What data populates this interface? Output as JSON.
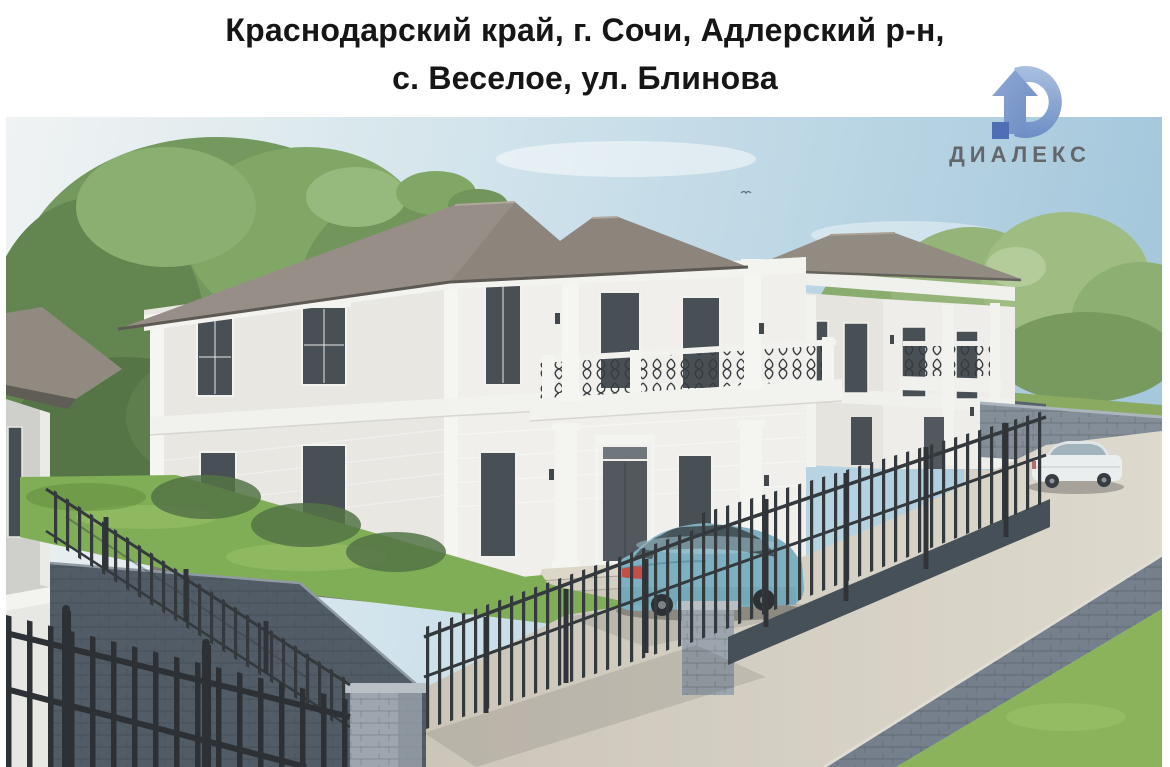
{
  "header": {
    "title_line1": "Краснодарский край, г. Сочи, Адлерский р-н,",
    "title_line2": "с. Веселое, ул. Блинова",
    "text_color": "#161616"
  },
  "logo": {
    "text": "ДИАЛЕКС",
    "text_color": "#63666a",
    "icon": "house-arrow-icon",
    "icon_colors": {
      "light": "#a9c0e0",
      "mid": "#7e9bcc",
      "deep": "#5b79bc",
      "square": "#4f6fb5"
    }
  },
  "image": {
    "type": "3d-architectural-render",
    "description": "Two-storey classical-style white stucco houses with gray hip roofs, balconies with black wrought-iron railings and white columns, behind black metal picket fences with stone pillars; teal sedan parked at the entrance, white sedan on the sloped road to the right, green trees and lawns around, stone retaining walls along the street.",
    "objects": [
      {
        "name": "main-house",
        "color": "#f2f0ec"
      },
      {
        "name": "second-house",
        "color": "#f0eeea"
      },
      {
        "name": "neighbor-house-left",
        "color": "#d3d3cf"
      },
      {
        "name": "hip-roofs",
        "color": "#948b82"
      },
      {
        "name": "wrought-iron-balconies",
        "color": "#2e3236"
      },
      {
        "name": "metal-picket-fences",
        "color": "#2c3034"
      },
      {
        "name": "stone-pillars",
        "color": "#9aa3ac"
      },
      {
        "name": "teal-sedan",
        "color": "#79adbe"
      },
      {
        "name": "white-sedan",
        "color": "#eef0f1"
      },
      {
        "name": "trees",
        "color": "#6f9557"
      },
      {
        "name": "lawn",
        "color": "#7cab4e"
      },
      {
        "name": "road",
        "color": "#cfc8bb"
      },
      {
        "name": "stone-retaining-walls",
        "color": "#7f8a94"
      },
      {
        "name": "sky",
        "color": "#a3c7dc"
      }
    ]
  }
}
